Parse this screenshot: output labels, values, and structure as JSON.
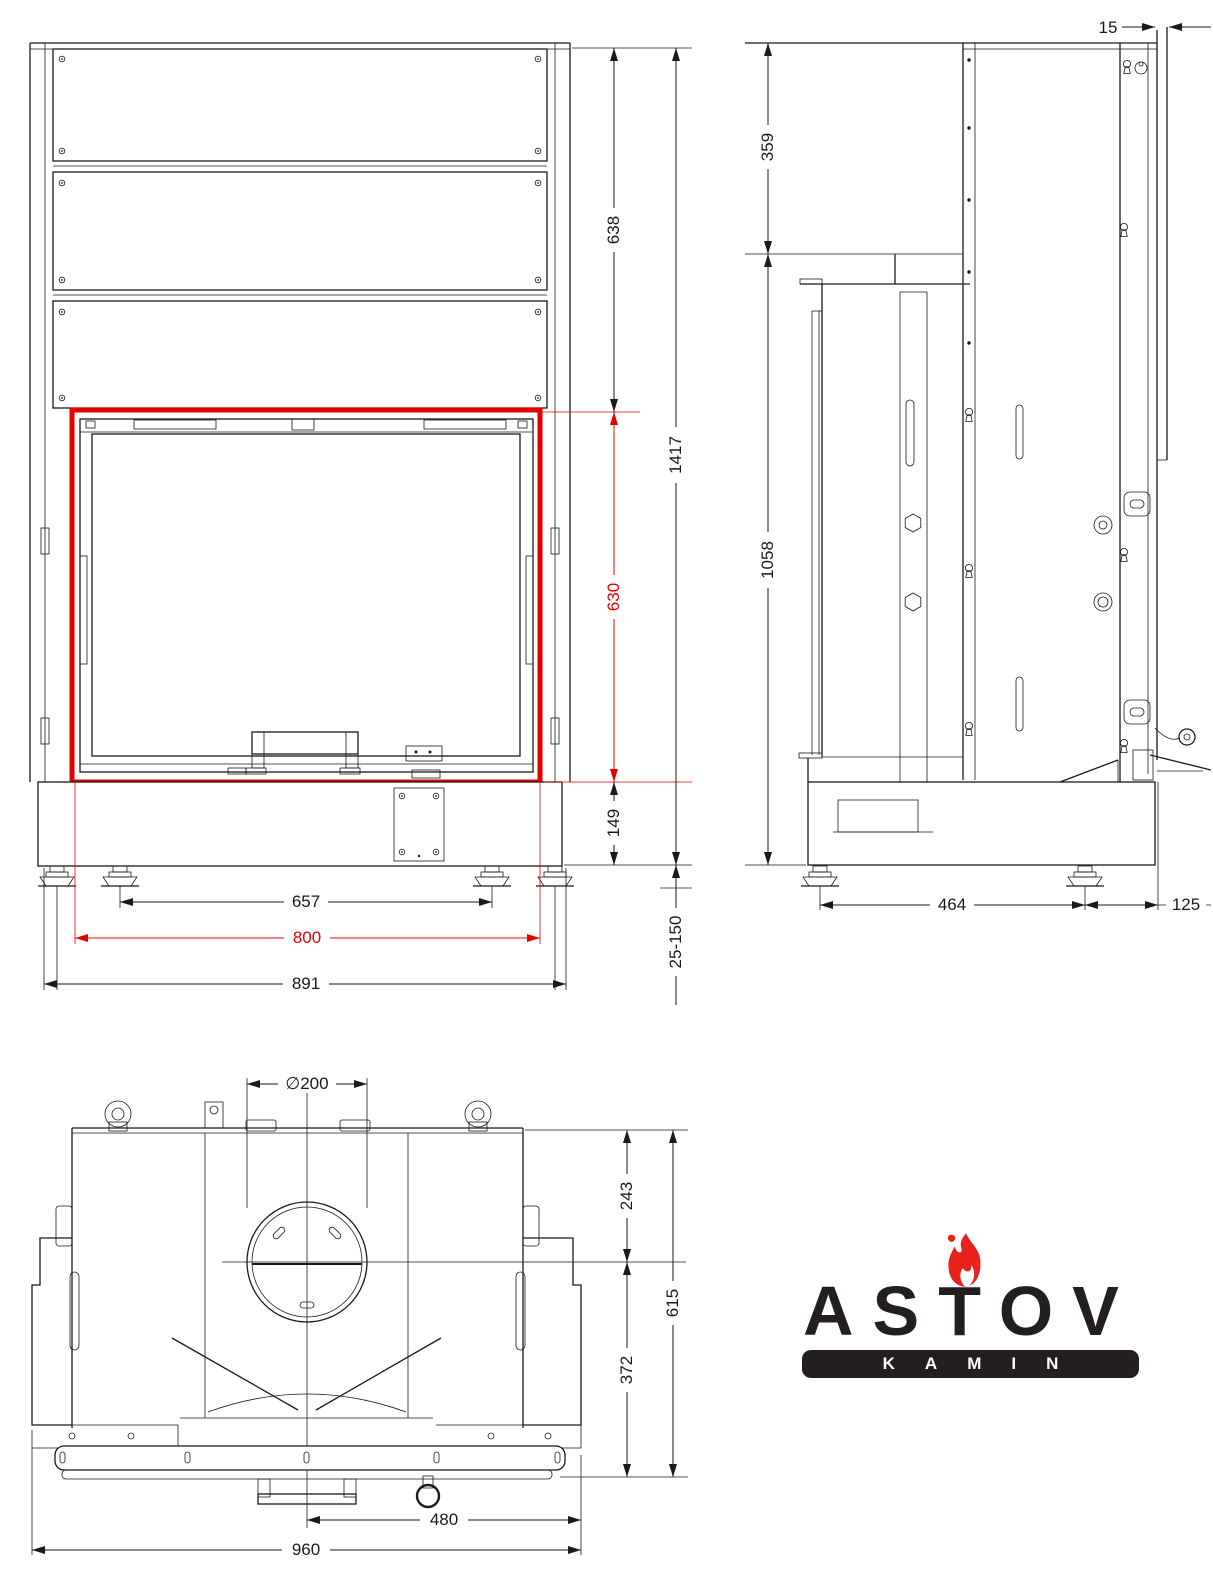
{
  "drawing_title": "Fireplace insert technical drawing (three views)",
  "colors": {
    "line": "#1a1a1a",
    "accent_red": "#e60000",
    "logo_black": "#231f20",
    "flame_red": "#e8211d"
  },
  "views": {
    "front": {
      "dims": {
        "panels_height": "638",
        "opening_height": "630",
        "base_height": "149",
        "total_height": "1417",
        "feet_spacing": "657",
        "opening_width": "800",
        "overall_width": "891",
        "leg_adjust": "25-150"
      }
    },
    "side": {
      "dims": {
        "front_lip": "15",
        "top_section": "359",
        "body_height": "1058",
        "feet_spacing": "464",
        "rear_offset": "125"
      }
    },
    "top": {
      "dims": {
        "flue_diameter": "∅200",
        "rear_to_flue": "243",
        "flue_to_front": "372",
        "overall_depth": "615",
        "center_to_edge": "480",
        "overall_width": "960"
      }
    }
  },
  "logo": {
    "brand": "ASTOV",
    "subtitle": "KAMIN",
    "icon": "flame-icon"
  }
}
